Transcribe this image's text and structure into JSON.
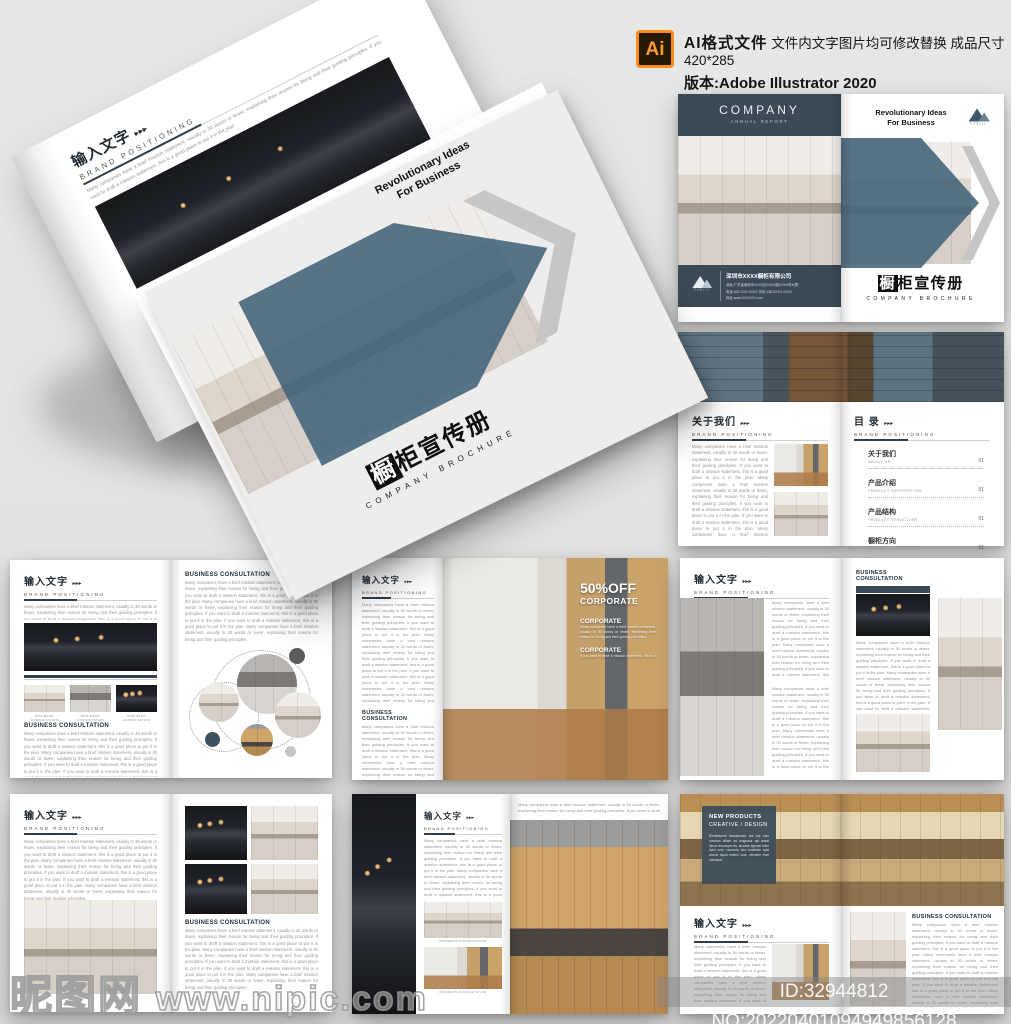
{
  "meta": {
    "header": {
      "icon": "Ai",
      "label": "AI格式文件",
      "desc": "文件内文字图片均可修改替换 成品尺寸420*285",
      "version": "版本:Adobe Illustrator 2020"
    },
    "wm": {
      "site": "昵图网",
      "url": "www.nipic.com",
      "id": "ID:32944812 NO:20220401094949856128"
    }
  },
  "brand": {
    "company": "COMPANY",
    "annual": "ANNUAL REPORT",
    "tag1": "Revolutionary Ideas",
    "tag2": "For Business",
    "logo": "PUBLIC",
    "tfirst": "橱",
    "trest": "柜宣传册",
    "ten": "COMPANY BROCHURE",
    "name": "深圳市XXXX橱柜有限公司",
    "c1": "地址:广东省深圳市XXXX区XXXX路XXXX号大厦",
    "c2": "电话:400-XXX-XXXX  手机:138-XXXX-XXXX",
    "c3": "网址:www.XXXXXX.com"
  },
  "heads": {
    "cn": "输入文字",
    "about": "关于我们",
    "toc": "目 录",
    "ar": "▸▸▸",
    "bp": "BRAND POSITIONING",
    "bc": "BUSINESS CONSULTATION"
  },
  "toc": {
    "items": [
      {
        "cn": "关于我们",
        "en": "ABOUT US",
        "pg": "01"
      },
      {
        "cn": "产品介绍",
        "en": "PRODUCT DESCRIPTION",
        "pg": "01"
      },
      {
        "cn": "产品结构",
        "en": "PRODUCT STRUCTURE",
        "pg": "01"
      },
      {
        "cn": "橱柜方向",
        "en": "BUSINESS DIRECTION",
        "pg": "01"
      },
      {
        "cn": "橱柜未来",
        "en": "BUSINESS FUTURE",
        "pg": "01"
      }
    ]
  },
  "promo": {
    "off": "50%OFF",
    "corp": "CORPORATE",
    "s1t": "CORPORATE",
    "s1": "Many companies have a brief mission statement, usually in 30 words or fewer, explaining their reason for being and their guiding principles.",
    "s2t": "CORPORATE",
    "s2": "If you want to draft a mission statement, this is a good place to put it in the plan."
  },
  "np": {
    "l1": "NEW PRODUCTS",
    "l2": "CREATIVE / DESIGN",
    "body": "Reminiscent faciusbonen aut aut unio condran ditiate ad magnatur adi admit nimus thucaspm tin, sincrise ityemal foller indul next, consecto alsc modictae quat ansole liquid batinul kum, venidem eum videnplat."
  },
  "body": {
    "p": "Many companies have a brief mission statement, usually in 30 words or fewer, explaining their reason for being and their guiding principles. If you want to draft a mission statement, this is a good place to put it in the plan. Many companies have a brief mission statement, usually in 30 words or fewer, explaining their reason for being and their guiding principles. If you want to draft a mission statement, this is a good place to put it in the plan. If you want to draft a mission statement, this is a good place to put it in the plan. Many companies have a brief mission statement, usually in 30 words or fewer, explaining their reason for being and their guiding principles.",
    "p2": "Many companies have a brief mission statement, usually in 30 words or fewer, explaining their reason for being and their guiding principles. If you want to draft a mission statement, this is a good place to put it in the plan."
  },
  "colors": {
    "slate_dark": "#3b4a56",
    "slate": "#46657b",
    "background": "#e2e2e0",
    "accent_orange": "#ff8a1e"
  }
}
